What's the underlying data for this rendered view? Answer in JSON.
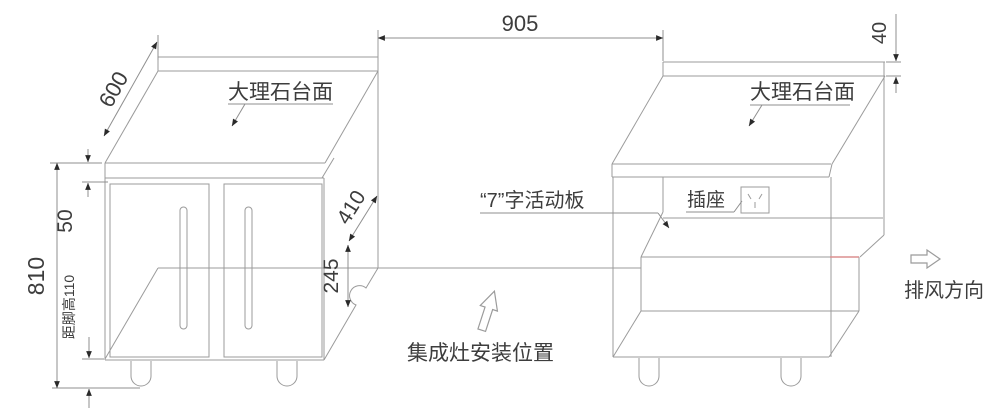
{
  "drawing": {
    "title_hint": "integrated-stove-cabinet-installation-diagram",
    "labels": {
      "countertop_left": "大理石台面",
      "countertop_right": "大理石台面",
      "movable_panel": "“7”字活动板",
      "socket": "插座",
      "exhaust_direction": "排风方向",
      "stove_position": "集成灶安装位置"
    },
    "dimensions": {
      "gap_width": "905",
      "countertop_depth": "600",
      "top_gap": "50",
      "total_height": "810",
      "foot_height_note": "距脚高110",
      "side_depth": "410",
      "recess_height": "245",
      "countertop_thickness": "40"
    },
    "colors": {
      "line": "#9b9b9b",
      "dimension_line": "#8f8f8f",
      "text": "#3d3d3d",
      "highlight_line": "#dc8f8f",
      "arrowhead": "#2a2a2a",
      "background": "#ffffff"
    }
  }
}
